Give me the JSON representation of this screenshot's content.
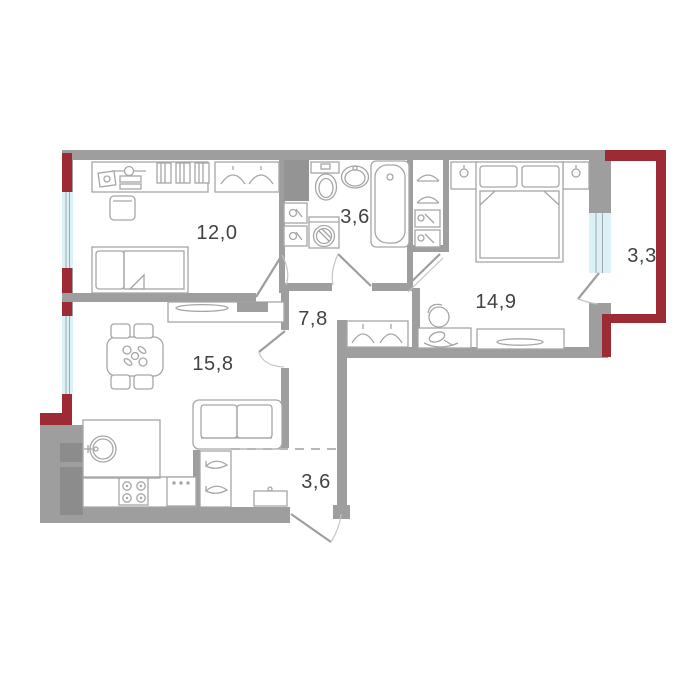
{
  "plan": {
    "type": "apartment-floor-plan",
    "rooms": [
      {
        "id": "bedroom",
        "area_label": "12,0"
      },
      {
        "id": "bathroom",
        "area_label": "3,6"
      },
      {
        "id": "master-bedroom",
        "area_label": "14,9"
      },
      {
        "id": "balcony",
        "area_label": "3,3"
      },
      {
        "id": "hallway",
        "area_label": "7,8"
      },
      {
        "id": "living-kitchen",
        "area_label": "15,8"
      },
      {
        "id": "entry-hall",
        "area_label": "3,6"
      }
    ],
    "colors": {
      "walls": "#9E9E9E",
      "accent_walls": "#9C2B35",
      "windows": "#DAF1F8",
      "furniture_outline": "#A6A6A6",
      "labels": "#424242",
      "floor": "#FFFFFF"
    }
  }
}
